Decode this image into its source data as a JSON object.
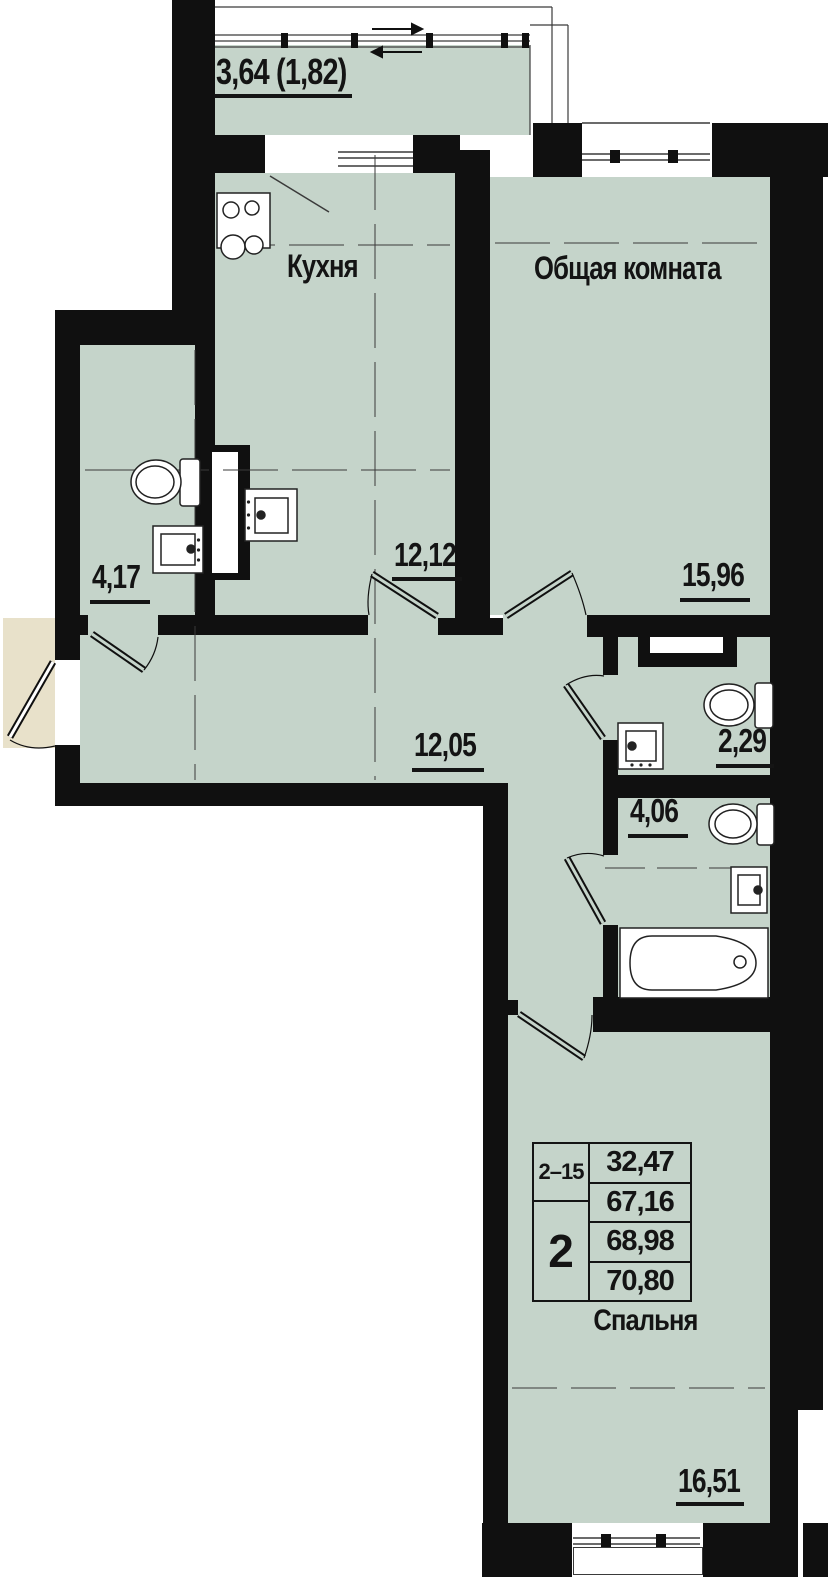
{
  "plan": {
    "balcony": {
      "area": "3,64 (1,82)"
    },
    "kitchen": {
      "name": "Кухня",
      "area": "12,12"
    },
    "living_room": {
      "name": "Общая комната",
      "area": "15,96"
    },
    "bathroom_small": {
      "area": "4,17"
    },
    "hallway": {
      "area": "12,05"
    },
    "wc": {
      "area": "2,29"
    },
    "bathroom": {
      "area": "4,06"
    },
    "bedroom": {
      "name": "Спальня",
      "area": "16,51"
    }
  },
  "stamp": {
    "unit_range": "2–15",
    "room_count": "2",
    "values": {
      "v1": "32,47",
      "v2": "67,16",
      "v3": "68,98",
      "v4": "70,80"
    }
  },
  "colors": {
    "floor": "#c5d4ca",
    "wall": "#101010",
    "vestibule": "#e8e1ca",
    "line": "#3a3a3a",
    "ink": "#141414"
  }
}
